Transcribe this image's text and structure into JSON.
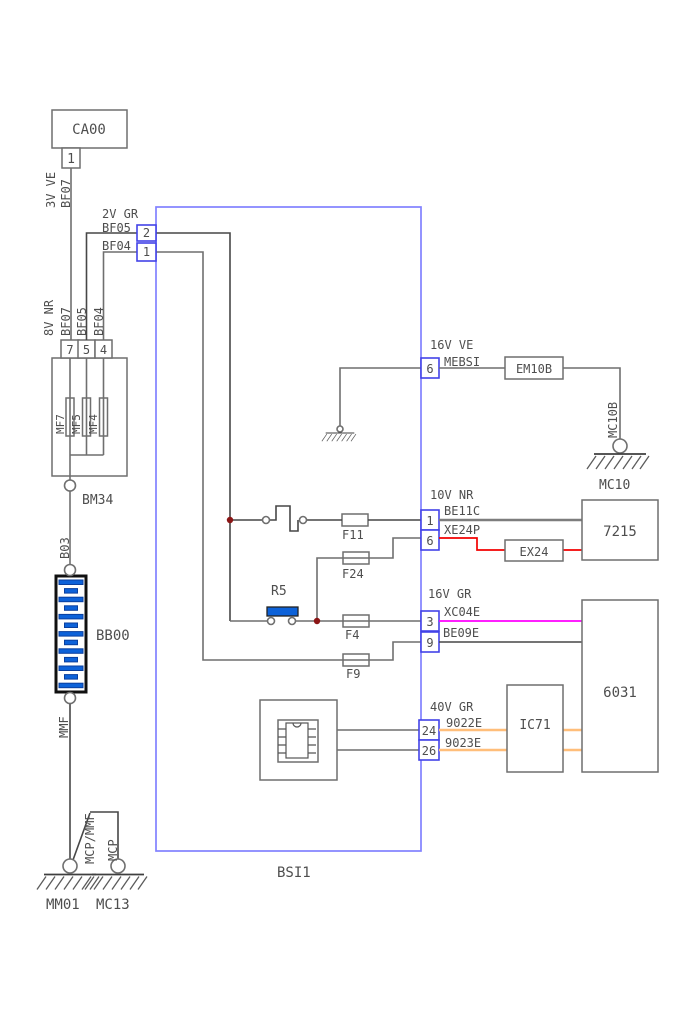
{
  "colors": {
    "bsi_border": "#8282ff",
    "pin_border": "#4343e8",
    "wire_gray": "#6f6f6f",
    "wire_red": "#f20000",
    "wire_magenta": "#ff00ff",
    "wire_orange": "#ffbe7a",
    "battery_blue": "#0d62d9",
    "junction_dot": "#8b1515",
    "text": "#4e4e4e"
  },
  "supply": {
    "ca00": {
      "label": "CA00",
      "pin": "1",
      "gauge": "3V VE",
      "wire": "BF07"
    },
    "fusebox": {
      "gauge": "8V NR",
      "wires": [
        "BF07",
        "BF05",
        "BF04"
      ],
      "pins": [
        "7",
        "5",
        "4"
      ],
      "fuses": [
        "MF7",
        "MF5",
        "MF4"
      ],
      "outlet": "BM34"
    },
    "battery": {
      "wire_above": "B03",
      "label": "BB00",
      "wire_below": "MMF"
    },
    "ground": {
      "wire_main": "MCP/MMF",
      "main": "MM01",
      "wire_branch": "MCP",
      "branch": "MC13"
    }
  },
  "bsi": {
    "label": "BSI1",
    "left": {
      "gauge": "2V GR",
      "pin2": "2",
      "wire2": "BF05",
      "pin1": "1",
      "wire1": "BF04"
    },
    "relay": "R5",
    "fuses": {
      "f11": "F11",
      "f24": "F24",
      "f4": "F4",
      "f9": "F9"
    },
    "right": {
      "mebsi": {
        "gauge": "16V VE",
        "wire": "MEBSI",
        "pin": "6"
      },
      "be11c": {
        "gauge": "10V NR",
        "wire": "BE11C",
        "pin": "1"
      },
      "xe24p": {
        "wire": "XE24P",
        "pin": "6"
      },
      "xc04e": {
        "gauge": "16V GR",
        "wire": "XC04E",
        "pin": "3"
      },
      "be09e": {
        "wire": "BE09E",
        "pin": "9"
      },
      "p9022": {
        "gauge": "40V GR",
        "wire": "9022E",
        "pin": "24"
      },
      "p9023": {
        "wire": "9023E",
        "pin": "26"
      }
    }
  },
  "right": {
    "em10b": {
      "label": "EM10B",
      "wire": "MC10B",
      "ground": "MC10"
    },
    "ex24": {
      "label": "EX24"
    },
    "u7215": {
      "label": "7215"
    },
    "u6031": {
      "label": "6031"
    },
    "ic71": {
      "label": "IC71"
    }
  }
}
